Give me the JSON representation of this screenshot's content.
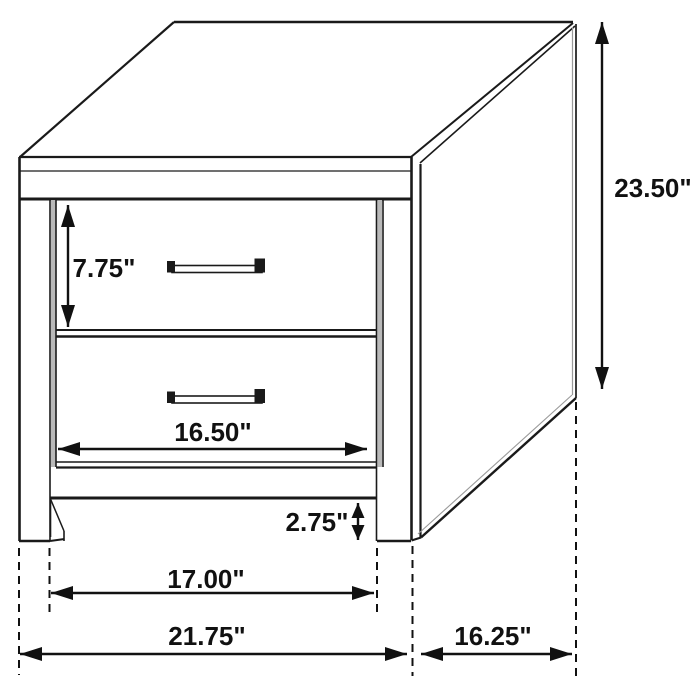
{
  "drawing": {
    "subject": "2-drawer nightstand technical dimension diagram",
    "view": "three-quarter perspective line drawing",
    "units": "inches",
    "drawer_count": 2,
    "colors": {
      "background": "#ffffff",
      "line": "#1a1a1a",
      "dimension": "#111111",
      "shade": "#b9b9b9"
    }
  },
  "dim_labels": {
    "overall_height": "23.50\"",
    "drawer_height": "7.75\"",
    "drawer_width": "16.50\"",
    "foot_clearance": "2.75\"",
    "between_legs_width": "17.00\"",
    "overall_width": "21.75\"",
    "overall_depth": "16.25\""
  }
}
